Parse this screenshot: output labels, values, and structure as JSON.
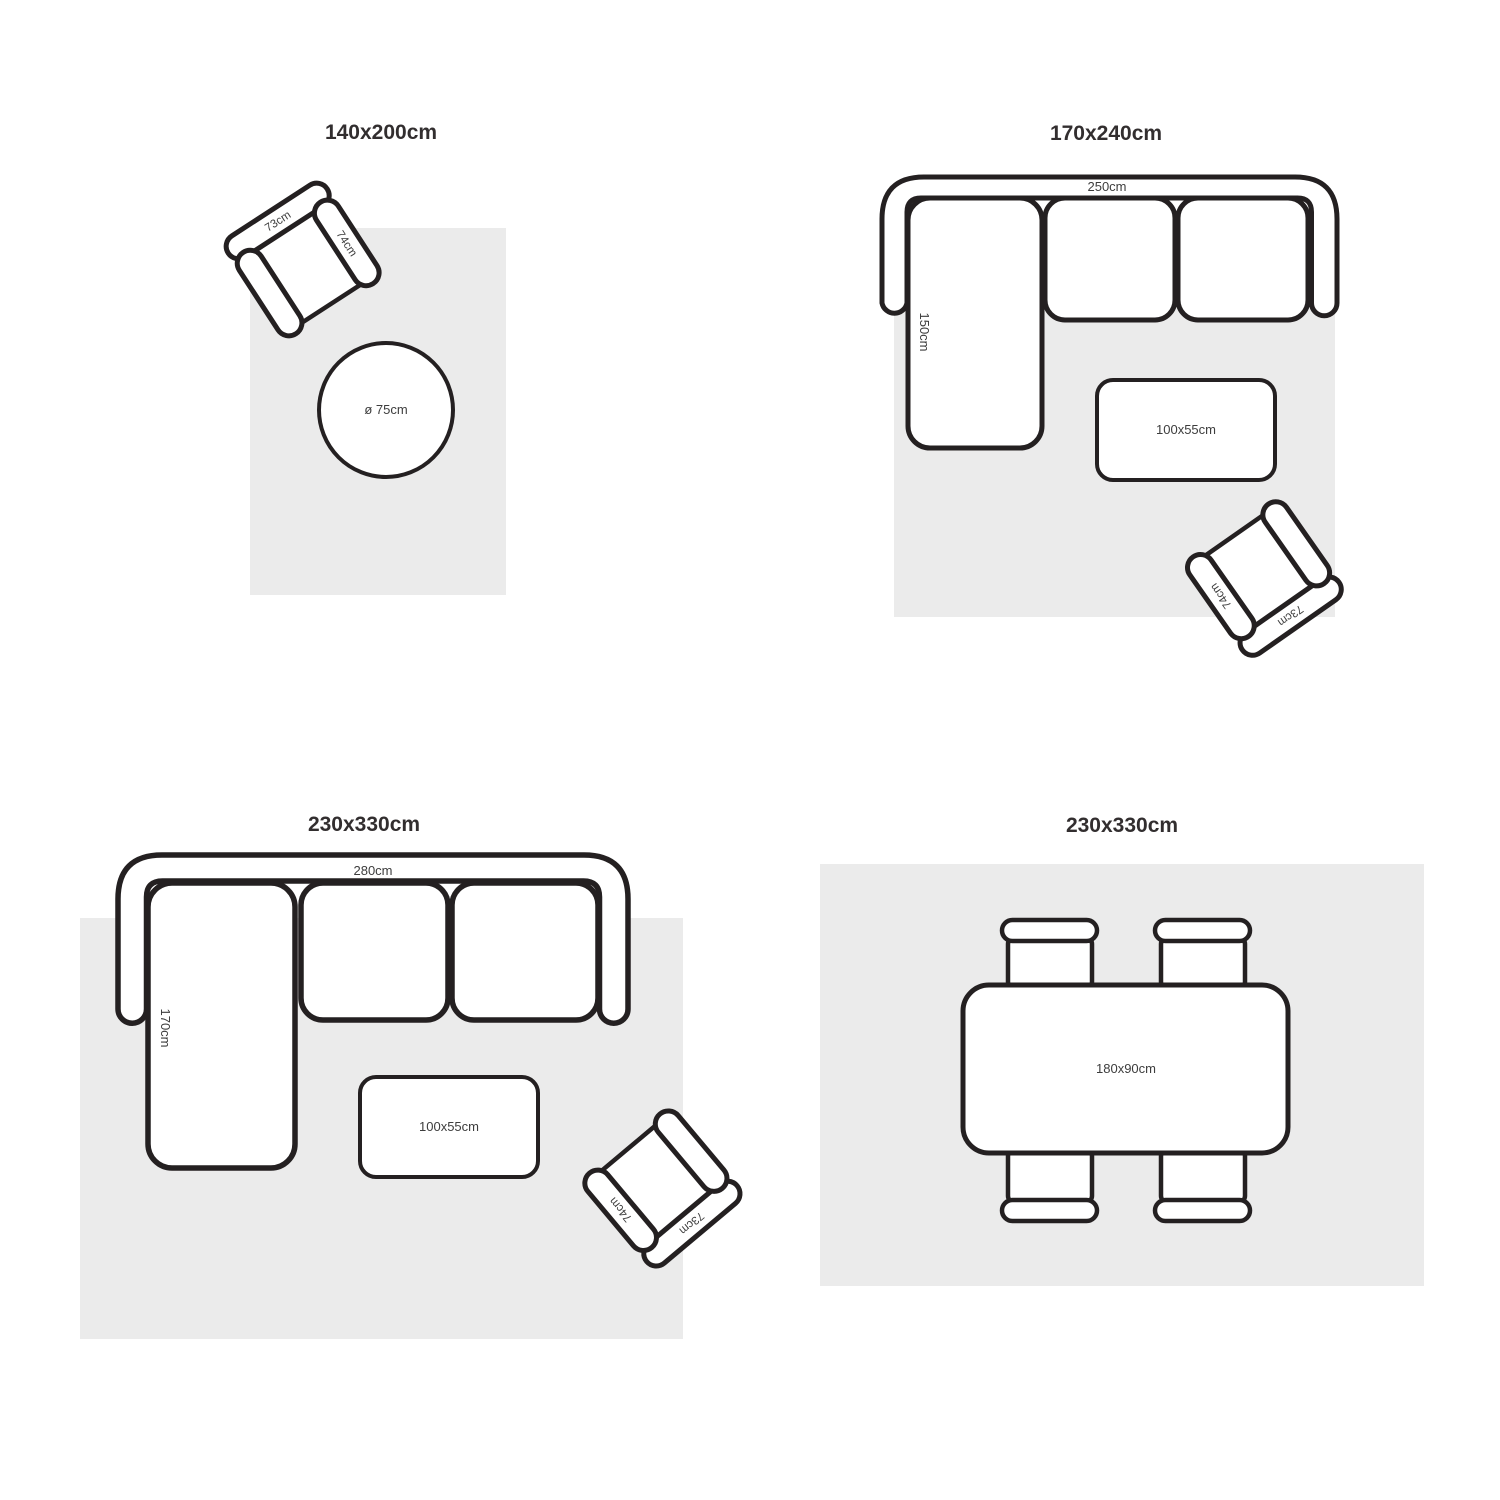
{
  "colors": {
    "outline": "#242021",
    "rug": "#ebebeb",
    "title": "#322e2f",
    "label": "#3d3d3d",
    "bg": "#ffffff"
  },
  "armchair": {
    "back_label": "73cm",
    "arm_label": "74cm"
  },
  "quadrants": [
    {
      "id": "q1",
      "title": "140x200cm",
      "round_table_label": "ø 75cm"
    },
    {
      "id": "q2",
      "title": "170x240cm",
      "sofa_width_label": "250cm",
      "chaise_label": "150cm",
      "coffee_table_label": "100x55cm"
    },
    {
      "id": "q3",
      "title": "230x330cm",
      "sofa_width_label": "280cm",
      "chaise_label": "170cm",
      "coffee_table_label": "100x55cm"
    },
    {
      "id": "q4",
      "title": "230x330cm",
      "table_label": "180x90cm"
    }
  ]
}
